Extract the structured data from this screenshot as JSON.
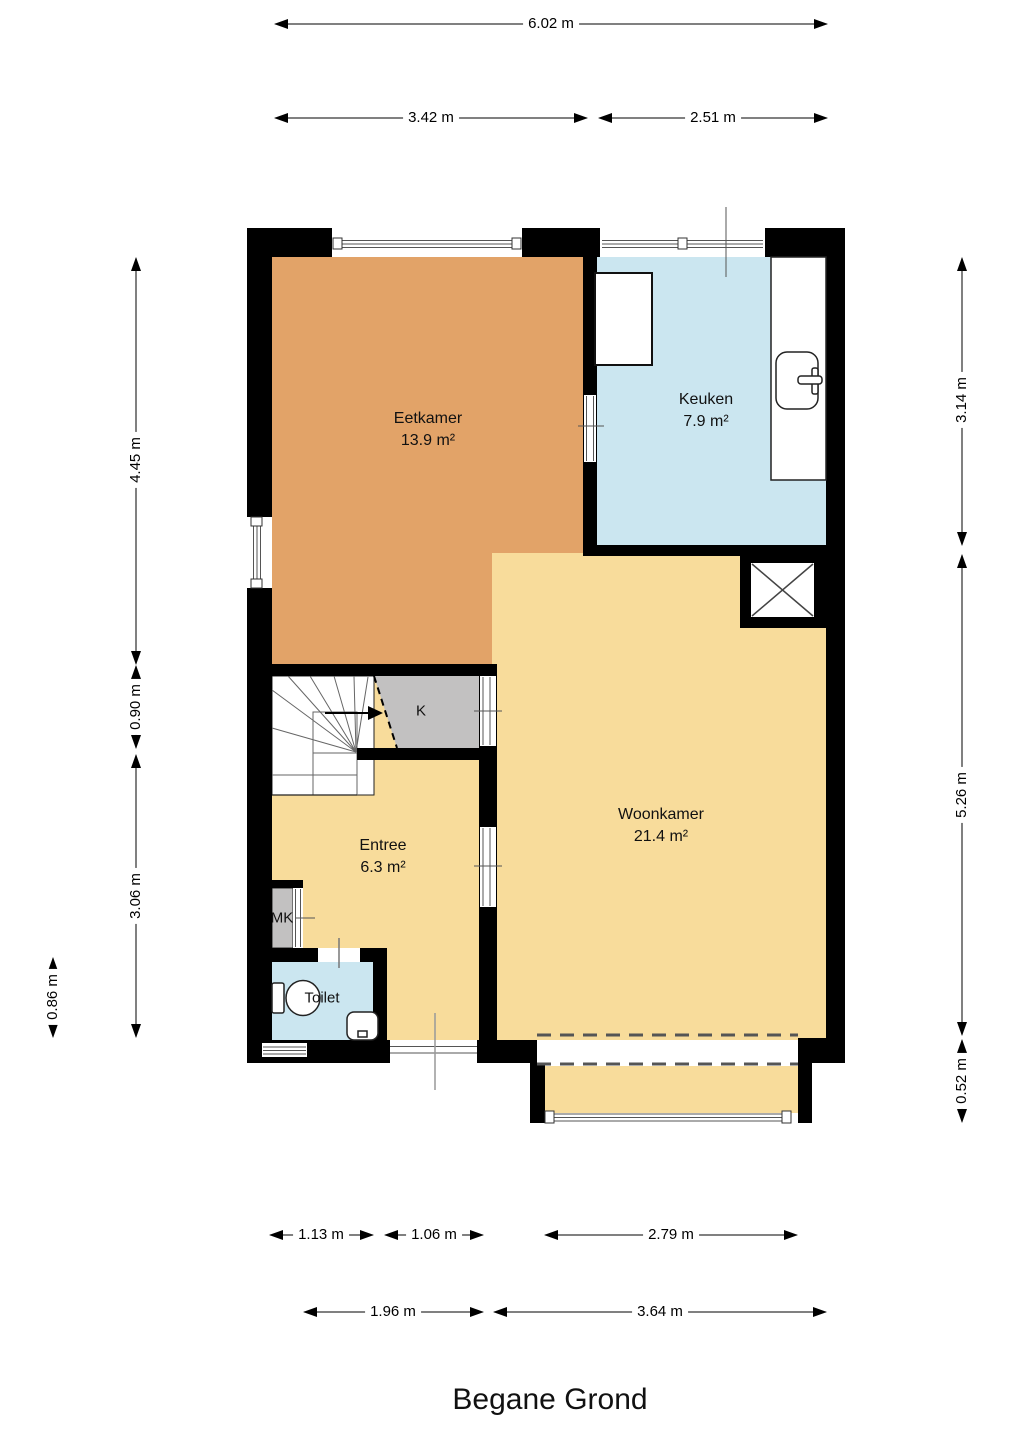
{
  "floor_plan": {
    "title": "Begane Grond",
    "rooms": {
      "eetkamer": {
        "name": "Eetkamer",
        "area": "13.9 m²"
      },
      "keuken": {
        "name": "Keuken",
        "area": "7.9 m²"
      },
      "woonkamer": {
        "name": "Woonkamer",
        "area": "21.4 m²"
      },
      "entree": {
        "name": "Entree",
        "area": "6.3 m²"
      },
      "toilet": {
        "name": "Toilet"
      },
      "kast": {
        "name": "K"
      },
      "meterkast": {
        "name": "MK"
      }
    },
    "dimensions": {
      "top_total": "6.02 m",
      "top_left_segment": "3.42 m",
      "top_right_segment": "2.51 m",
      "right_upper": "3.14 m",
      "right_middle": "5.26 m",
      "right_lower": "0.52 m",
      "left_upper": "4.45 m",
      "left_stairs": "0.90 m",
      "left_lower": "3.06 m",
      "left_toilet": "0.86 m",
      "bottom_toilet": "1.13 m",
      "bottom_entree": "1.06 m",
      "bottom_bay": "2.79 m",
      "bottom_left_total": "1.96 m",
      "bottom_right_total": "3.64 m"
    },
    "colors": {
      "eet": "#E2A368",
      "woon": "#F8DC9B",
      "keuk": "#CBE6F0",
      "toi": "#CBE6F0",
      "entree": "#F8DC9B",
      "closet": "#C2C1C1",
      "wall": "#000000"
    }
  }
}
